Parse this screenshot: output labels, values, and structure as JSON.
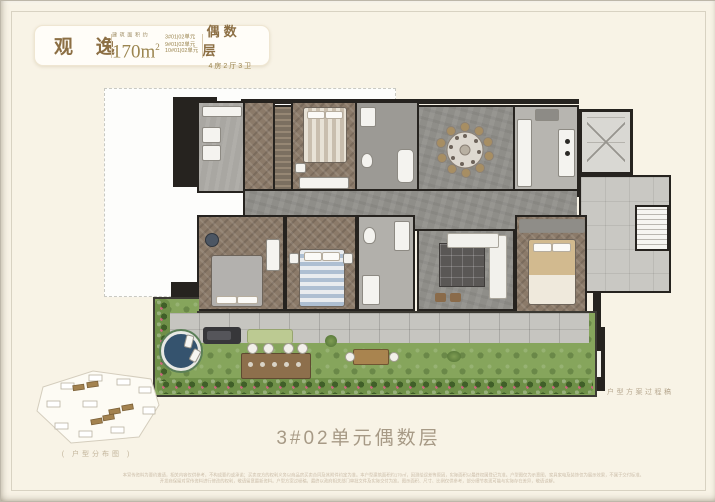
{
  "colors": {
    "background": "#f8f3e6",
    "accent_gold": "#8c6f44",
    "text_brown": "#9b854f",
    "caption_gray": "#a79a86",
    "wall_black": "#26231f",
    "wood_floor": "#8b7a69",
    "marble_floor": "#8f8e89",
    "terrace_grass": "#86a55c",
    "pool_blue": "#35536e"
  },
  "header": {
    "title": "观 逸",
    "area_label": "建筑面积约",
    "area_value": "170m",
    "area_sup": "2",
    "units": [
      "3#01|02单元",
      "9#01|02单元",
      "10#01|02单元"
    ],
    "floor_type": "偶数层",
    "layout": "4房2厅3卫"
  },
  "caption": {
    "main": "3#02单元偶数层",
    "site_map": "( 户型分布图 )"
  },
  "watermark": {
    "text": "户型方案过程稿"
  },
  "disclaimer": {
    "line1": "本宣传资料为要约邀请，相关内容仅供参考，不构成要约或承诺；买卖双方的权利义务以商品房买卖合同及其附件约定为准。本户型建筑面积约170㎡，因测绘误差等原因，实际面积以最终权属登记为准。户型图仅为示意图，家具家电及装饰仅为展示效果，不属于交付标准。",
    "line2": "开发商保留对宣传资料进行修改的权利，敬请留意最新资料。户型方案过程稿，最终以政府相关部门审批文件及实际交付为准。图示面积、尺寸、比例仅供参考，部分细节表现可能与实际存在差异，敬请谅解。"
  }
}
